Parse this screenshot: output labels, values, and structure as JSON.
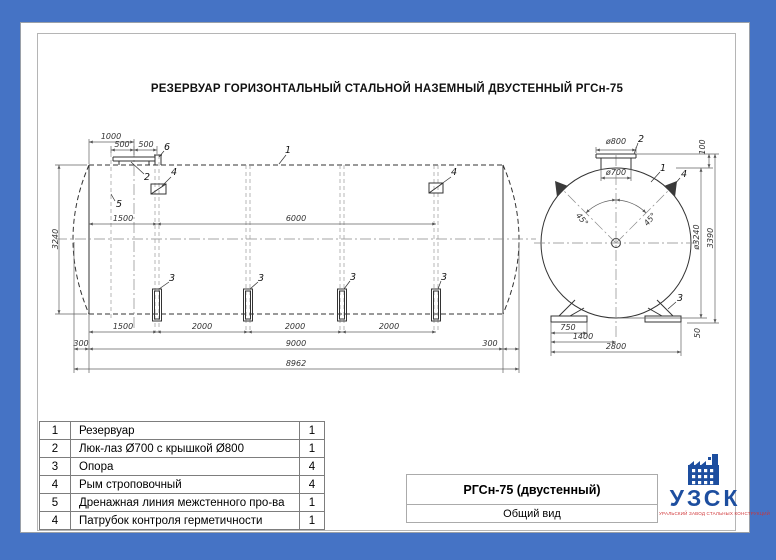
{
  "sheet": {
    "title": "РЕЗЕРВУАР ГОРИЗОНТАЛЬНЫЙ СТАЛЬНОЙ НАЗЕМНЫЙ ДВУСТЕННЫЙ РГСн-75"
  },
  "side_view": {
    "dims": {
      "top_1000": "1000",
      "top_500a": "500",
      "top_500b": "500",
      "mid_1500": "1500",
      "mid_6000": "6000",
      "left_3240": "3240",
      "bot_1500": "1500",
      "bot_2000a": "2000",
      "bot_2000b": "2000",
      "bot_2000c": "2000",
      "bot_300l": "300",
      "bot_9000": "9000",
      "bot_300r": "300",
      "bot_8962": "8962"
    },
    "callouts": {
      "c1": "1",
      "c2": "2",
      "c3": "3",
      "c4": "4",
      "c5": "5",
      "c6": "6"
    }
  },
  "end_view": {
    "dims": {
      "d800": "ø800",
      "d700": "ø700",
      "d100": "100",
      "d3240": "ø3240",
      "d3390": "3390",
      "d50": "50",
      "d750": "750",
      "d1400": "1400",
      "d2800": "2800",
      "angle_left": "45°",
      "angle_right": "45°"
    },
    "callouts": {
      "c1": "1",
      "c2": "2",
      "c3": "3",
      "c4": "4"
    }
  },
  "parts_table": {
    "rows": [
      {
        "no": "1",
        "name": "Резервуар",
        "qty": "1"
      },
      {
        "no": "2",
        "name": "Люк-лаз Ø700 с крышкой Ø800",
        "qty": "1"
      },
      {
        "no": "3",
        "name": "Опора",
        "qty": "4"
      },
      {
        "no": "4",
        "name": "Рым строповочный",
        "qty": "4"
      },
      {
        "no": "5",
        "name": "Дренажная линия межстенного про-ва",
        "qty": "1"
      },
      {
        "no": "4",
        "name": "Патрубок контроля герметичности",
        "qty": "1"
      }
    ]
  },
  "title_block": {
    "model": "РГСн-75 (двустенный)",
    "view_name": "Общий вид"
  },
  "logo": {
    "name": "УЗСК",
    "tagline": "УРАЛЬСКИЙ ЗАВОД СТАЛЬНЫХ КОНСТРУКЦИЙ",
    "brand_color": "#1d4e9f",
    "tagline_color": "#d03336"
  },
  "colors": {
    "background": "#4573c5",
    "page": "#ffffff"
  }
}
